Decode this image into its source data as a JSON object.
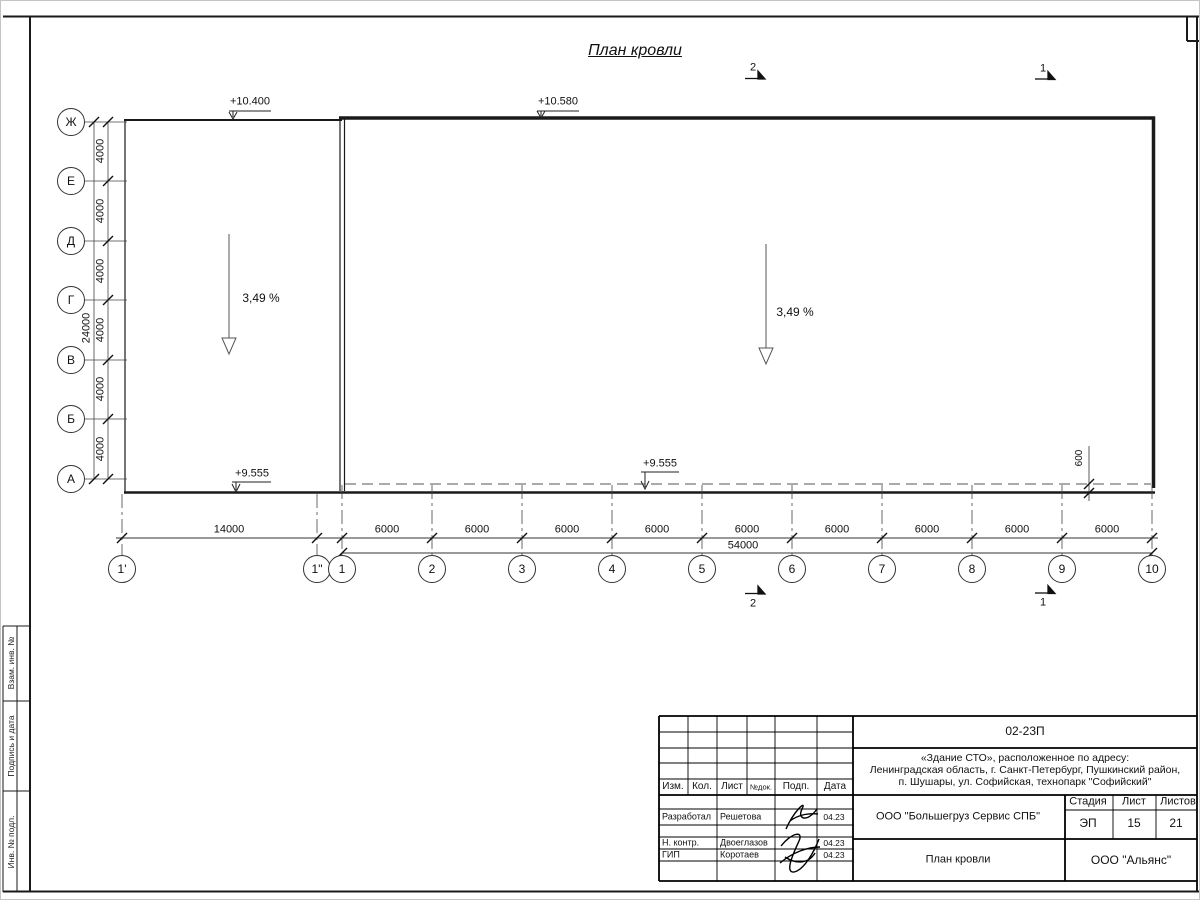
{
  "plan": {
    "title": "План кровли",
    "rows": [
      "Ж",
      "Е",
      "Д",
      "Г",
      "В",
      "Б",
      "А"
    ],
    "row_dims": [
      "4000",
      "4000",
      "4000",
      "4000",
      "4000",
      "4000"
    ],
    "row_total": "24000",
    "cols": [
      "1'",
      "1\"",
      "1",
      "2",
      "3",
      "4",
      "5",
      "6",
      "7",
      "8",
      "9",
      "10"
    ],
    "first_bay_dim": "14000",
    "bay_dims": [
      "6000",
      "6000",
      "6000",
      "6000",
      "6000",
      "6000",
      "6000",
      "6000",
      "6000"
    ],
    "col_total": "54000",
    "elev_annex_top": "+10.400",
    "elev_main_top": "+10.580",
    "elev_annex_bottom": "+9.555",
    "elev_main_bottom": "+9.555",
    "slope_left": "3,49 %",
    "slope_right": "3,49 %",
    "parapet_offset": "600",
    "section_top_2": "2",
    "section_top_1": "1",
    "section_bottom_2": "2",
    "section_bottom_1": "1"
  },
  "sidebar": {
    "labels": [
      "Взам. инв. №",
      "Подпись и дата",
      "Инв. № подл."
    ]
  },
  "titleblock": {
    "doc_number": "02-23П",
    "address_line1": "«Здание СТО», расположенное по адресу:",
    "address_line2": "Ленинградская область, г. Санкт-Петербург, Пушкинский район,",
    "address_line3": "п. Шушары, ул. Софийская, технопарк \"Софийский\"",
    "header": [
      "Изм.",
      "Кол.",
      "Лист",
      "№док.",
      "Подп.",
      "Дата"
    ],
    "sig_rows": [
      {
        "role": "Разработал",
        "name": "Решетова",
        "date": "04.23"
      },
      {
        "role": "Н. контр.",
        "name": "Двоеглазов",
        "date": "04.23"
      },
      {
        "role": "ГИП",
        "name": "Коротаев",
        "date": "04.23"
      }
    ],
    "company": "ООО \"Большегруз Сервис СПБ\"",
    "stage_label": "Стадия",
    "stage_value": "ЭП",
    "sheet_label": "Лист",
    "sheet_value": "15",
    "sheets_label": "Листов",
    "sheets_value": "21",
    "drawing_name": "План кровли",
    "org_name": "ООО \"Альянс\""
  }
}
